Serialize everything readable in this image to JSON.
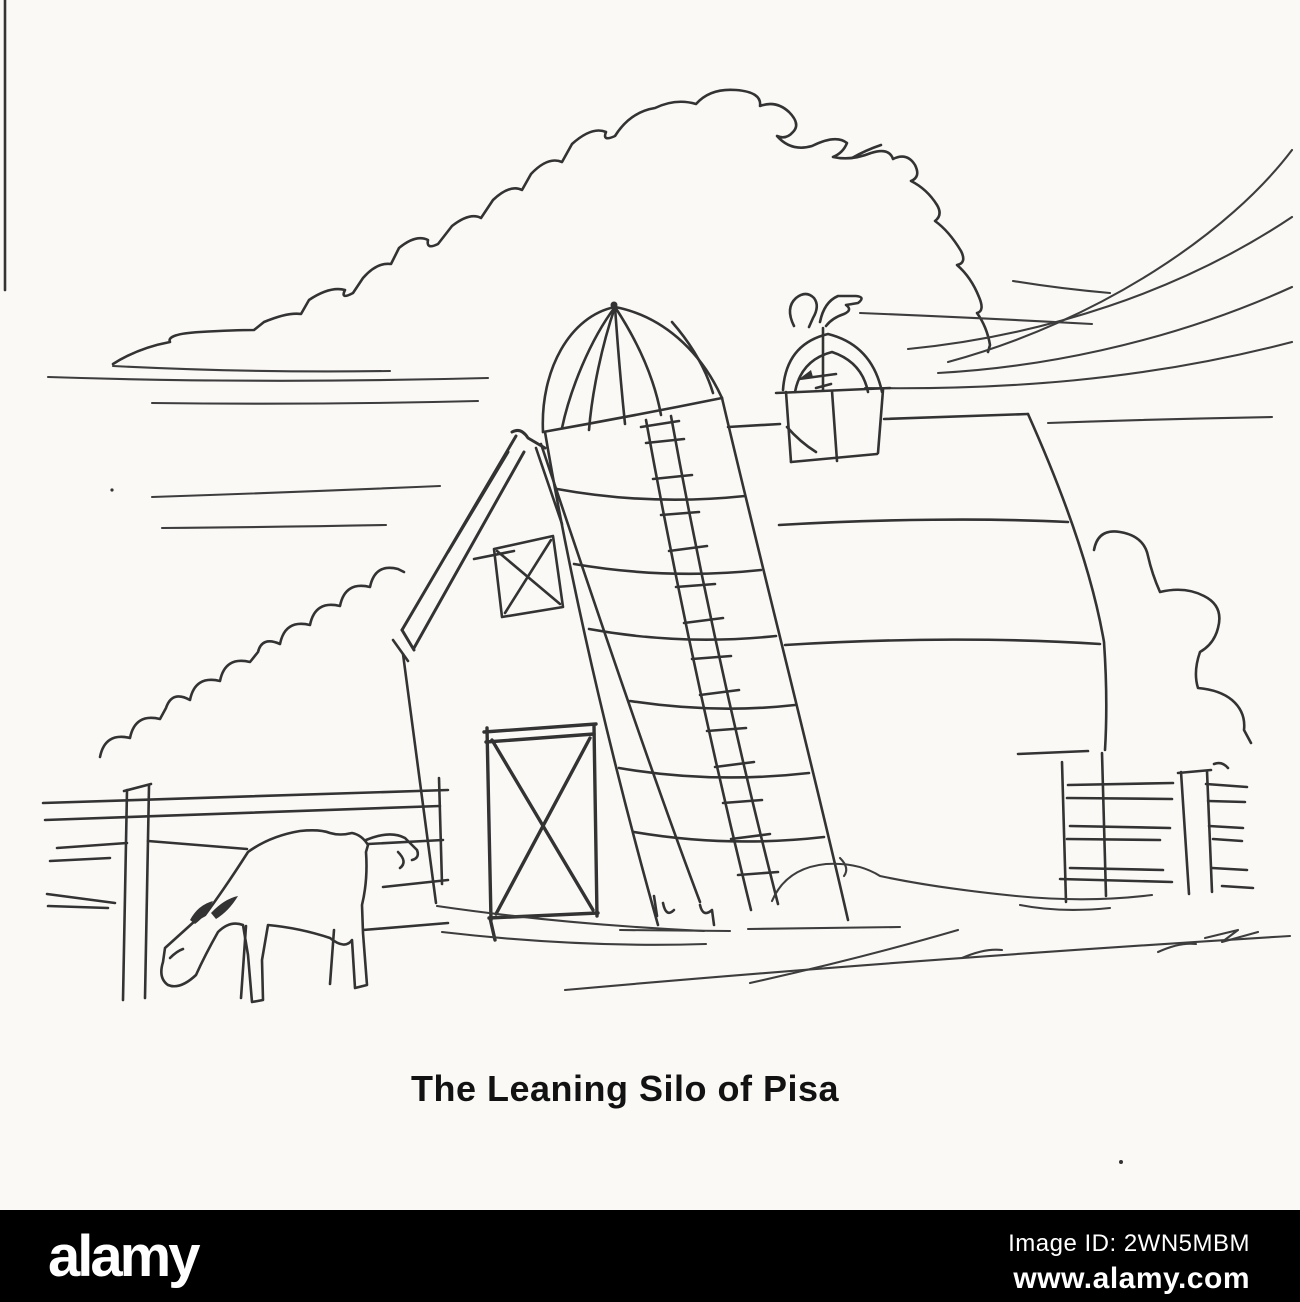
{
  "page": {
    "paper_color": "#faf9f6",
    "ink_color": "#333333"
  },
  "cartoon": {
    "caption": "The Leaning Silo of Pisa",
    "scene_elements": [
      "cumulus-cloud",
      "sky-lines",
      "wind-swoosh-lines",
      "barn",
      "hayloft-window",
      "barn-door",
      "barn-roof",
      "cupola",
      "rooster-weathervane",
      "leaning-silo",
      "silo-ladder",
      "grazing-cow",
      "left-fence",
      "right-fence",
      "left-tree",
      "right-tree",
      "ground-strokes"
    ]
  },
  "watermark": {
    "logo_text": "alamy",
    "image_id": "Image ID: 2WN5MBM",
    "url": "www.alamy.com",
    "bar_color": "#000000",
    "text_color": "#ffffff"
  }
}
